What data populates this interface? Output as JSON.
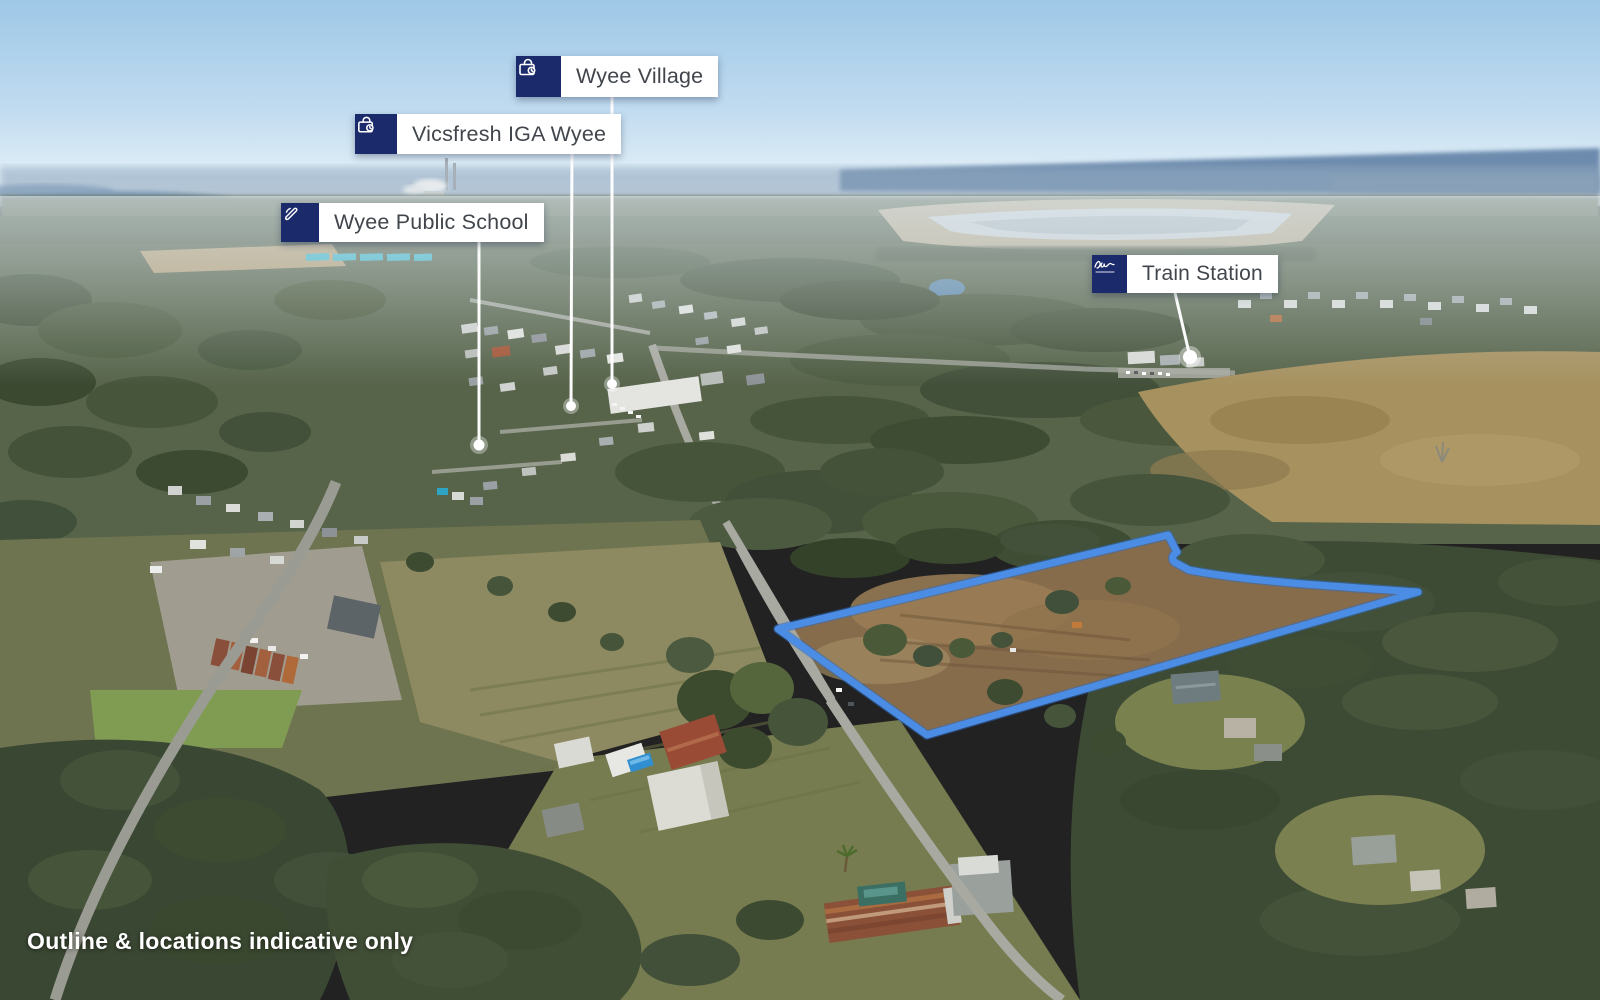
{
  "annotations": {
    "village": {
      "text": "Wyee Village",
      "icon": "shopping-bag-icon"
    },
    "iga": {
      "text": "Vicsfresh IGA Wyee",
      "icon": "shopping-bag-icon"
    },
    "school": {
      "text": "Wyee Public School",
      "icon": "pencil-icon"
    },
    "station": {
      "text": "Train Station",
      "icon": "agency-logo-icon"
    }
  },
  "disclaimer": {
    "text": "Outline & locations indicative only"
  },
  "colors": {
    "label_box": "#1b2a6b",
    "label_text": "#41464c",
    "property_outline": "#4b8de4",
    "leader_line": "#ffffff"
  }
}
